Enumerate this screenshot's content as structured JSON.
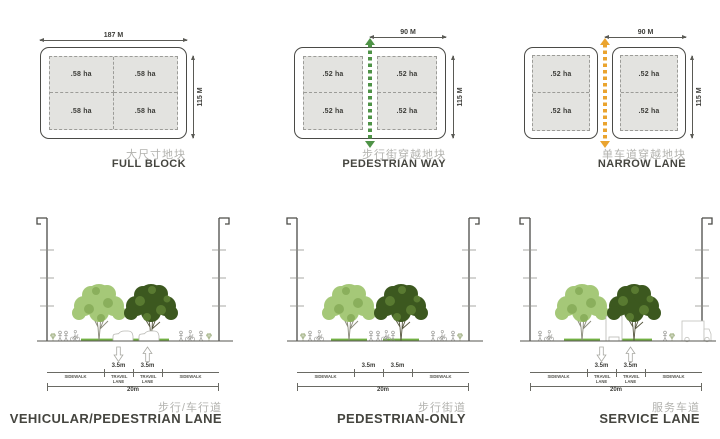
{
  "blocks": [
    {
      "title_cn": "大尺寸地块",
      "title_en": "FULL BLOCK",
      "dim_top": "187 M",
      "dim_side": "115 M",
      "cells": [
        ".58 ha",
        ".58 ha",
        ".58 ha",
        ".58 ha"
      ]
    },
    {
      "title_cn": "步行街穿越地块",
      "title_en": "PEDESTRIAN WAY",
      "dim_top": "90 M",
      "dim_side": "115 M",
      "cells": [
        ".52 ha",
        ".52 ha",
        ".52 ha",
        ".52 ha"
      ]
    },
    {
      "title_cn": "单车道穿越地块",
      "title_en": "NARROW LANE",
      "dim_top": "90 M",
      "dim_side": "115 M",
      "cells": [
        ".52 ha",
        ".52 ha",
        ".52 ha",
        ".52 ha"
      ]
    }
  ],
  "sections": [
    {
      "title_cn": "步行/车行道",
      "title_en": "VEHICULAR/PEDESTRIAN LANE",
      "lanes": [
        "3.5m",
        "3.5m"
      ],
      "total": "20m",
      "zones": [
        "SIDEWALK",
        "TRAVEL LANE",
        "TRAVEL LANE",
        "SIDEWALK"
      ]
    },
    {
      "title_cn": "步行街道",
      "title_en": "PEDESTRIAN-ONLY",
      "lanes": [
        "3.5m",
        "3.5m"
      ],
      "total": "20m",
      "zones": [
        "SIDEWALK",
        "",
        "",
        "SIDEWALK"
      ]
    },
    {
      "title_cn": "服务车道",
      "title_en": "SERVICE LANE",
      "lanes": [
        "3.5m",
        "3.5m"
      ],
      "total": "20m",
      "zones": [
        "SIDEWALK",
        "TRAVEL LANE",
        "TRAVEL LANE",
        "SIDEWALK"
      ]
    }
  ],
  "colors": {
    "arrow-green": "#4f9347",
    "arrow-orange": "#eaa42f",
    "block-fill": "#e3e3e0",
    "tree-light": "#a5c878",
    "tree-light-2": "#86ab58",
    "tree-dark": "#3c581f",
    "tree-dark-2": "#5d7e33",
    "grass": "#72b043",
    "label-grey": "#b2b2ae",
    "label-dark": "#45453f",
    "figure": "#9a9a96"
  }
}
